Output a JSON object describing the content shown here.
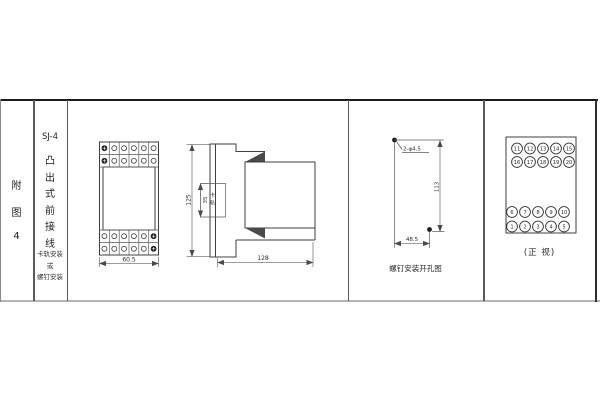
{
  "figure": {
    "row_label_chars": [
      "附",
      "图",
      "4"
    ],
    "model": "SJ-4",
    "type_chars": [
      "凸",
      "出",
      "式",
      "前",
      "接",
      "线"
    ],
    "mount_lines": [
      "卡轨安装",
      "或",
      "螺钉安装"
    ]
  },
  "front_view": {
    "width_dim": "60.5"
  },
  "side_view": {
    "height_dim": "125",
    "depth_dim": "128",
    "rail_dim": "35",
    "rail_label_chars": [
      "卡",
      "轨"
    ]
  },
  "drill_view": {
    "holes_label": "2-φ4.5",
    "height_dim": "113",
    "width_dim": "48.5",
    "caption": "螺钉安装开孔图"
  },
  "terminal_view": {
    "caption": "(正 视)",
    "top_rows": [
      [
        "11",
        "12",
        "13",
        "14",
        "15"
      ],
      [
        "16",
        "17",
        "18",
        "19",
        "20"
      ]
    ],
    "bottom_rows": [
      [
        "6",
        "7",
        "8",
        "9",
        "10"
      ],
      [
        "1",
        "2",
        "3",
        "4",
        "5"
      ]
    ]
  }
}
